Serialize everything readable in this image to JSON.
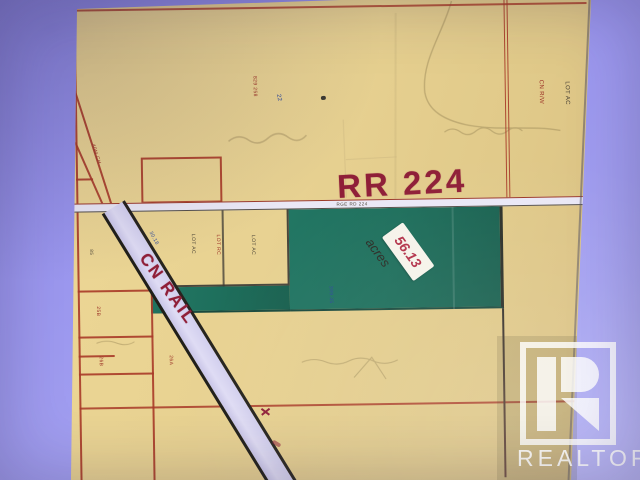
{
  "scene": {
    "description": "Photograph of a county plat map used as a real-estate listing image",
    "colors": {
      "background_lavender": "#9b97ef",
      "paper_tan": "#e8d292",
      "parcel_green": "#1e6f5c",
      "survey_red": "#a83a28",
      "marker_maroon": "#8f1f38",
      "rail_fill": "#d9d6f0"
    }
  },
  "map": {
    "road_label": "RR 224",
    "road_tiny_label": "RGE RD 224",
    "rail_label": "CN RAIL",
    "sticker": {
      "value": "56.13",
      "unit": "acres"
    },
    "labels": {
      "forty_m": "40M CH",
      "lot_ac_1": "LOT AC",
      "lot_ac_2": "LOT AC",
      "lot_rc_red": "LOT RC",
      "right_red": "CN R/W",
      "right_black": "LOT AC",
      "top_red": "829 258",
      "top_blue": "22",
      "left_black": "85",
      "left_red_1": "25B",
      "left_red_2": "26B",
      "left_red_3": "26A",
      "dim_blue_1": "30.18",
      "dim_blue_2": "399.35"
    }
  },
  "watermark": {
    "brand": "REALTOR",
    "reg": "®"
  }
}
